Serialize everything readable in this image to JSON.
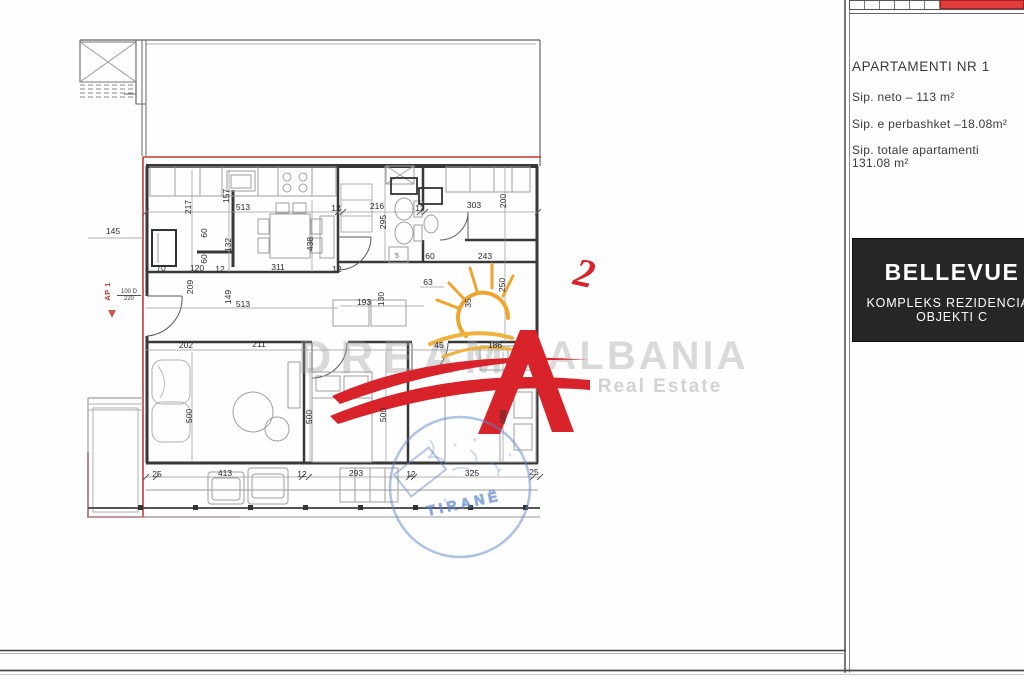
{
  "panel": {
    "apartment_title": "APARTAMENTI NR 1",
    "sip_neto": "Sip. neto –  113 m²",
    "sip_perbashket": "Sip. e perbashket –18.08m²",
    "sip_totale_line1": "Sip. totale apartamenti",
    "sip_totale_line2": "131.08 m²",
    "project": {
      "name": "BELLEVUE",
      "subtitle1": "KOMPLEKS REZIDENCIAL",
      "subtitle2": "OBJEKTI C"
    },
    "colors": {
      "keyplan_red": "#e23b3b",
      "box_bg": "#262626",
      "box_text": "#ffffff"
    }
  },
  "watermark": {
    "word_left": "DREAM",
    "word_right": "ALBANIA",
    "subtitle": "Real Estate",
    "logo_mark": "2",
    "logo_red": "#d8232a",
    "sun_orange": "#efa42f"
  },
  "stamp": {
    "city": "TIRANË",
    "color": "#5b86cd"
  },
  "plan": {
    "unit_label": "AP 1",
    "entry_door_width": "100 D",
    "entry_door_height": "220",
    "shower_label": "5",
    "boundary_red": "#c43a33",
    "dimensions": [
      {
        "text": "145",
        "x": 113,
        "y": 231,
        "rot": 0
      },
      {
        "text": "217",
        "x": 188,
        "y": 207,
        "rot": -90
      },
      {
        "text": "157",
        "x": 226,
        "y": 196,
        "rot": -90
      },
      {
        "text": "513",
        "x": 243,
        "y": 207,
        "rot": 0
      },
      {
        "text": "12",
        "x": 336,
        "y": 208,
        "rot": 0
      },
      {
        "text": "216",
        "x": 377,
        "y": 206,
        "rot": 0
      },
      {
        "text": "295",
        "x": 383,
        "y": 222,
        "rot": -90
      },
      {
        "text": "12",
        "x": 420,
        "y": 208,
        "rot": 0
      },
      {
        "text": "303",
        "x": 474,
        "y": 205,
        "rot": 0
      },
      {
        "text": "200",
        "x": 503,
        "y": 201,
        "rot": -90
      },
      {
        "text": "60",
        "x": 204,
        "y": 233,
        "rot": -90
      },
      {
        "text": "60",
        "x": 204,
        "y": 259,
        "rot": -90
      },
      {
        "text": "132",
        "x": 228,
        "y": 245,
        "rot": -90
      },
      {
        "text": "438",
        "x": 310,
        "y": 244,
        "rot": -90
      },
      {
        "text": "70",
        "x": 161,
        "y": 268,
        "rot": 0
      },
      {
        "text": "120",
        "x": 197,
        "y": 268,
        "rot": 0
      },
      {
        "text": "12",
        "x": 220,
        "y": 269,
        "rot": 0
      },
      {
        "text": "311",
        "x": 278,
        "y": 267,
        "rot": 0
      },
      {
        "text": "12",
        "x": 337,
        "y": 269,
        "rot": 0
      },
      {
        "text": "60",
        "x": 430,
        "y": 256,
        "rot": 0
      },
      {
        "text": "243",
        "x": 485,
        "y": 256,
        "rot": 0
      },
      {
        "text": "209",
        "x": 190,
        "y": 287,
        "rot": -90
      },
      {
        "text": "149",
        "x": 228,
        "y": 297,
        "rot": -90
      },
      {
        "text": "513",
        "x": 243,
        "y": 304,
        "rot": 0
      },
      {
        "text": "193",
        "x": 364,
        "y": 302,
        "rot": 0
      },
      {
        "text": "130",
        "x": 381,
        "y": 299,
        "rot": -90
      },
      {
        "text": "63",
        "x": 428,
        "y": 282,
        "rot": 0
      },
      {
        "text": "35",
        "x": 468,
        "y": 303,
        "rot": -90
      },
      {
        "text": "250",
        "x": 502,
        "y": 285,
        "rot": -90
      },
      {
        "text": "202",
        "x": 186,
        "y": 345,
        "rot": 0
      },
      {
        "text": "211",
        "x": 259,
        "y": 344,
        "rot": 0
      },
      {
        "text": "45",
        "x": 439,
        "y": 345,
        "rot": 0
      },
      {
        "text": "186",
        "x": 495,
        "y": 345,
        "rot": 0
      },
      {
        "text": "500",
        "x": 189,
        "y": 416,
        "rot": -90
      },
      {
        "text": "500",
        "x": 309,
        "y": 417,
        "rot": -90
      },
      {
        "text": "500",
        "x": 383,
        "y": 415,
        "rot": -90
      },
      {
        "text": "488",
        "x": 503,
        "y": 417,
        "rot": -90
      },
      {
        "text": "25",
        "x": 157,
        "y": 474,
        "rot": 0
      },
      {
        "text": "413",
        "x": 225,
        "y": 473,
        "rot": 0
      },
      {
        "text": "12",
        "x": 302,
        "y": 474,
        "rot": 0
      },
      {
        "text": "293",
        "x": 356,
        "y": 473,
        "rot": 0
      },
      {
        "text": "12",
        "x": 411,
        "y": 474,
        "rot": 0
      },
      {
        "text": "325",
        "x": 472,
        "y": 473,
        "rot": 0
      },
      {
        "text": "25",
        "x": 534,
        "y": 472,
        "rot": 0
      }
    ]
  }
}
